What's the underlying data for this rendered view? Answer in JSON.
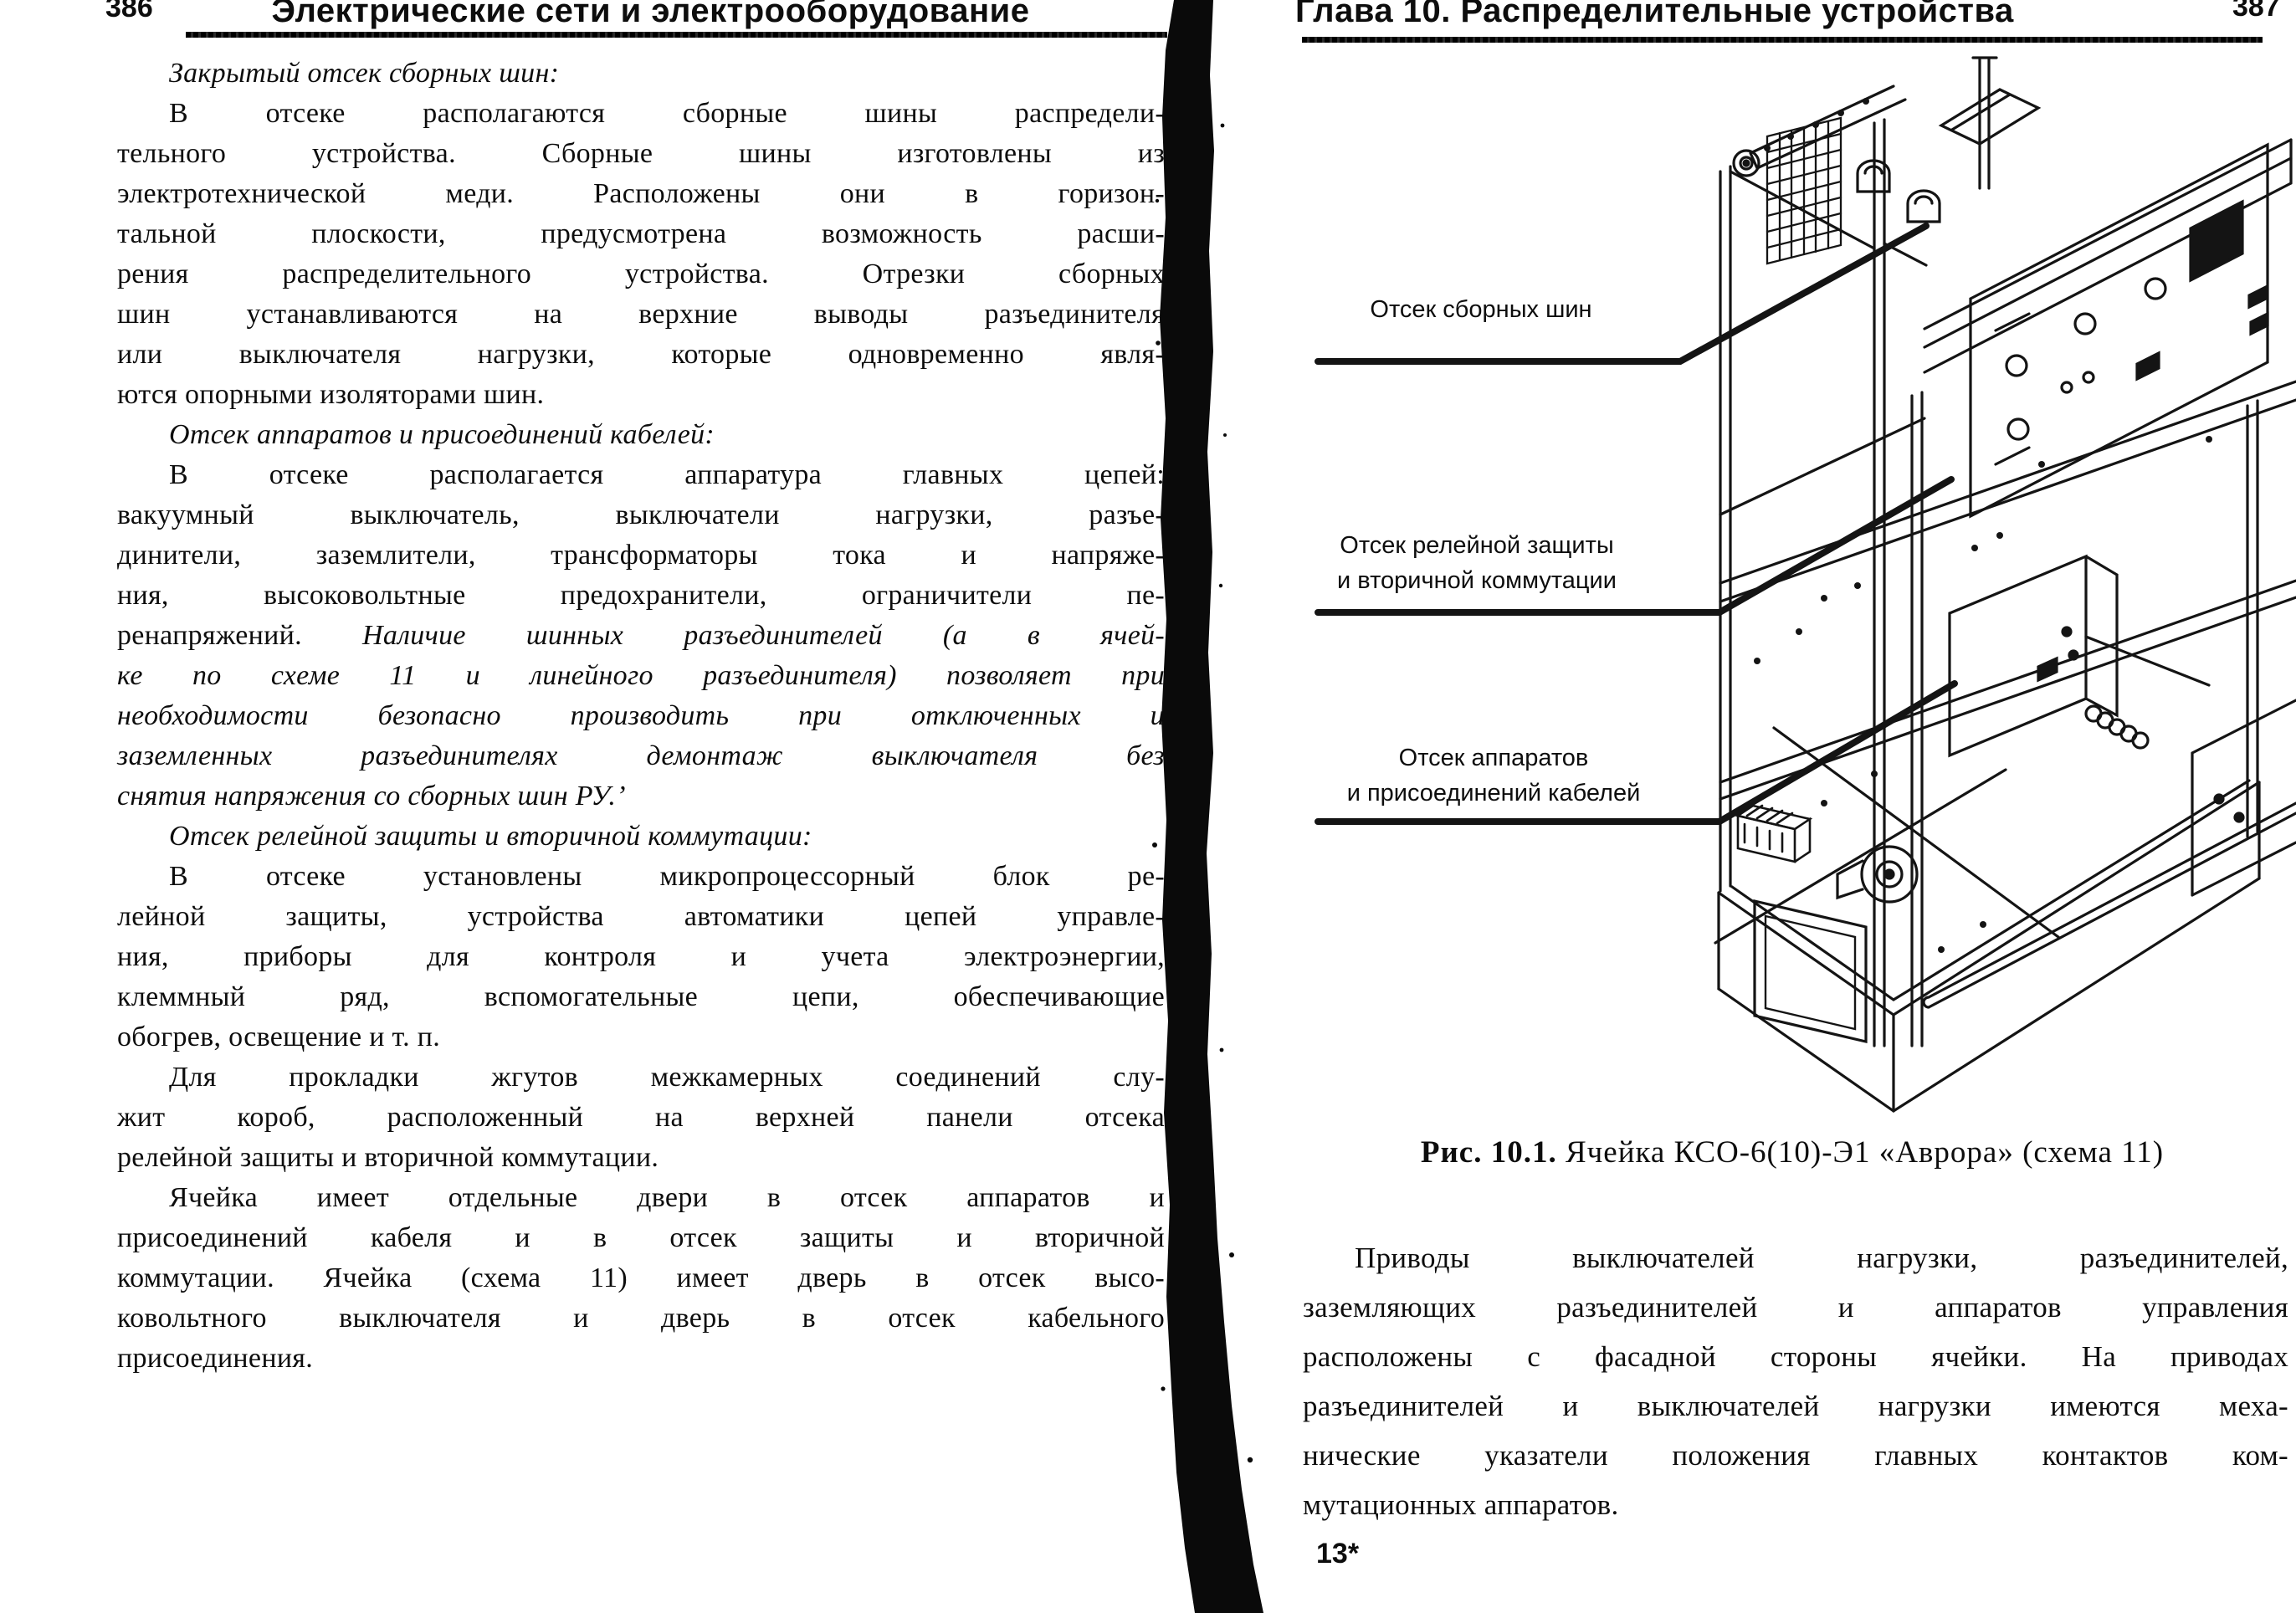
{
  "colors": {
    "ink": "#0d0d0d",
    "paper": "#ffffff"
  },
  "left_page": {
    "page_number": "386",
    "header_title": "Электрические сети и электрооборудование",
    "lines": [
      {
        "seg": [
          {
            "t": "Закрытый отсек сборных шин:",
            "i": 1
          }
        ],
        "ind": 1,
        "just": 0
      },
      {
        "seg": [
          {
            "t": "В отсеке располагаются сборные шины распредели-",
            "i": 0
          }
        ],
        "ind": 1,
        "just": 1
      },
      {
        "seg": [
          {
            "t": "тельного устройства. Сборные шины изготовлены из",
            "i": 0
          }
        ],
        "just": 1
      },
      {
        "seg": [
          {
            "t": "электротехнической меди. Расположены они в горизон-",
            "i": 0
          }
        ],
        "just": 1
      },
      {
        "seg": [
          {
            "t": "тальной плоскости, предусмотрена возможность расши-",
            "i": 0
          }
        ],
        "just": 1
      },
      {
        "seg": [
          {
            "t": "рения распределительного устройства. Отрезки сборных",
            "i": 0
          }
        ],
        "just": 1
      },
      {
        "seg": [
          {
            "t": "шин устанавливаются на верхние выводы разъединителя",
            "i": 0
          }
        ],
        "just": 1
      },
      {
        "seg": [
          {
            "t": "или выключателя нагрузки, которые одновременно явля-",
            "i": 0
          }
        ],
        "just": 1
      },
      {
        "seg": [
          {
            "t": "ются опорными изоляторами шин.",
            "i": 0
          }
        ],
        "just": 0
      },
      {
        "seg": [
          {
            "t": "Отсек аппаратов и присоединений кабелей:",
            "i": 1
          }
        ],
        "ind": 1,
        "just": 0
      },
      {
        "seg": [
          {
            "t": "В отсеке располагается аппаратура главных цепей:",
            "i": 0
          }
        ],
        "ind": 1,
        "just": 1
      },
      {
        "seg": [
          {
            "t": "вакуумный выключатель, выключатели нагрузки, разъе-",
            "i": 0
          }
        ],
        "just": 1
      },
      {
        "seg": [
          {
            "t": "динители, заземлители, трансформаторы тока и напряже-",
            "i": 0
          }
        ],
        "just": 1
      },
      {
        "seg": [
          {
            "t": "ния, высоковольтные предохранители, ограничители пе-",
            "i": 0
          }
        ],
        "just": 1
      },
      {
        "seg": [
          {
            "t": "ренапряжений. ",
            "i": 0
          },
          {
            "t": "Наличие шинных разъединителей (а в ячей-",
            "i": 1
          }
        ],
        "just": 1
      },
      {
        "seg": [
          {
            "t": "ке по схеме 11 и линейного разъединителя) позволяет при",
            "i": 1
          }
        ],
        "just": 1
      },
      {
        "seg": [
          {
            "t": "необходимости безопасно производить при отключенных и",
            "i": 1
          }
        ],
        "just": 1
      },
      {
        "seg": [
          {
            "t": "заземленных разъединителях демонтаж выключателя без",
            "i": 1
          }
        ],
        "just": 1
      },
      {
        "seg": [
          {
            "t": "снятия напряжения со сборных шин РУ.’",
            "i": 1
          }
        ],
        "just": 0
      },
      {
        "seg": [
          {
            "t": "Отсек релейной защиты и вторичной коммутации:",
            "i": 1
          }
        ],
        "ind": 1,
        "just": 0
      },
      {
        "seg": [
          {
            "t": "В отсеке установлены микропроцессорный блок ре-",
            "i": 0
          }
        ],
        "ind": 1,
        "just": 1
      },
      {
        "seg": [
          {
            "t": "лейной защиты, устройства автоматики цепей управле-",
            "i": 0
          }
        ],
        "just": 1
      },
      {
        "seg": [
          {
            "t": "ния, приборы для контроля и учета электроэнергии,",
            "i": 0
          }
        ],
        "just": 1
      },
      {
        "seg": [
          {
            "t": "клеммный ряд, вспомогательные цепи, обеспечивающие",
            "i": 0
          }
        ],
        "just": 1
      },
      {
        "seg": [
          {
            "t": "обогрев, освещение и т. п.",
            "i": 0
          }
        ],
        "just": 0
      },
      {
        "seg": [
          {
            "t": "Для прокладки жгутов межкамерных соединений слу-",
            "i": 0
          }
        ],
        "ind": 1,
        "just": 1
      },
      {
        "seg": [
          {
            "t": "жит короб, расположенный на верхней панели отсека",
            "i": 0
          }
        ],
        "just": 1
      },
      {
        "seg": [
          {
            "t": "релейной защиты и вторичной коммутации.",
            "i": 0
          }
        ],
        "just": 0
      },
      {
        "seg": [
          {
            "t": "Ячейка имеет отдельные двери в отсек аппаратов и",
            "i": 0
          }
        ],
        "ind": 1,
        "just": 1
      },
      {
        "seg": [
          {
            "t": "присоединений кабеля и в отсек защиты и вторичной",
            "i": 0
          }
        ],
        "just": 1
      },
      {
        "seg": [
          {
            "t": "коммутации. Ячейка (схема 11) имеет дверь в отсек высо-",
            "i": 0
          }
        ],
        "just": 1
      },
      {
        "seg": [
          {
            "t": "ковольтного выключателя и дверь в отсек кабельного",
            "i": 0
          }
        ],
        "just": 1
      },
      {
        "seg": [
          {
            "t": "присоединения.",
            "i": 0
          }
        ],
        "just": 0
      }
    ]
  },
  "right_page": {
    "page_number": "387",
    "header_title": "Глава 10. Распределительные устройства",
    "diagram_labels": [
      {
        "lines": [
          "Отсек сборных шин"
        ]
      },
      {
        "lines": [
          "Отсек релейной защиты",
          "и вторичной коммутации"
        ]
      },
      {
        "lines": [
          "Отсек аппаратов",
          "и присоединений кабелей"
        ]
      }
    ],
    "caption": {
      "prefix": "Рис. 10.1.",
      "text": " Ячейка КСО-6(10)-Э1 «Аврора» (схема 11)"
    },
    "lines": [
      {
        "seg": [
          {
            "t": "Приводы выключателей нагрузки, разъединителей,",
            "i": 0
          }
        ],
        "ind": 1,
        "just": 1
      },
      {
        "seg": [
          {
            "t": "заземляющих разъединителей и аппаратов управления",
            "i": 0
          }
        ],
        "just": 1
      },
      {
        "seg": [
          {
            "t": "расположены с фасадной стороны ячейки. На приводах",
            "i": 0
          }
        ],
        "just": 1
      },
      {
        "seg": [
          {
            "t": "разъединителей и выключателей нагрузки имеются меха-",
            "i": 0
          }
        ],
        "just": 1
      },
      {
        "seg": [
          {
            "t": "нические указатели положения главных контактов ком-",
            "i": 0
          }
        ],
        "just": 1
      },
      {
        "seg": [
          {
            "t": "мутационных аппаратов.",
            "i": 0
          }
        ],
        "just": 0
      }
    ],
    "footnote_mark": "13*"
  }
}
